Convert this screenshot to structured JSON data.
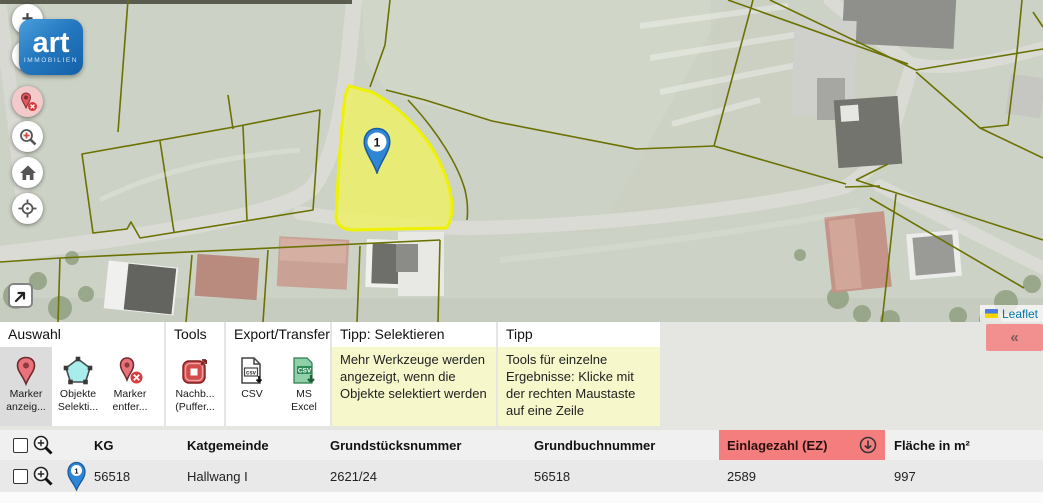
{
  "map": {
    "logo": {
      "line1": "art",
      "line2": "IMMOBILIEN"
    },
    "controls": {
      "zoom_in": "+",
      "zoom_out": "−",
      "icons": [
        "remove-markers-icon",
        "zoom-search-icon",
        "home-icon",
        "locate-icon",
        "expand-arrow-icon"
      ]
    },
    "marker_label": "1",
    "attribution": {
      "label": "Leaflet",
      "flag_icon": "ukraine-flag-icon"
    }
  },
  "toolbar": {
    "sections": [
      {
        "title": "Auswahl",
        "buttons": [
          {
            "label1": "Marker",
            "label2": "anzeig...",
            "icon": "marker-icon",
            "selected": true
          },
          {
            "label1": "Objekte",
            "label2": "Selekti...",
            "icon": "polygon-select-icon",
            "selected": false
          },
          {
            "label1": "Marker",
            "label2": "entfer...",
            "icon": "marker-remove-icon",
            "selected": false
          }
        ]
      },
      {
        "title": "Tools",
        "buttons": [
          {
            "label1": "Nachb...",
            "label2": "(Puffer...",
            "icon": "buffer-tool-icon",
            "selected": false
          }
        ]
      },
      {
        "title": "Export/Transfer",
        "buttons": [
          {
            "label1": "CSV",
            "label2": "",
            "icon": "csv-download-icon",
            "selected": false
          },
          {
            "label1": "MS",
            "label2": "Excel",
            "icon": "excel-download-icon",
            "selected": false
          }
        ]
      },
      {
        "title": "Tipp: Selektieren",
        "tip": "Mehr Werkzeuge werden angezeigt, wenn die Objekte selektiert werden"
      },
      {
        "title": "Tipp",
        "tip": "Tools für einzelne Ergebnisse: Klicke mit der rechten Maustaste auf eine Zeile"
      }
    ],
    "collapse_label": "«"
  },
  "table": {
    "columns": {
      "kg": "KG",
      "katgemeinde": "Katgemeinde",
      "grundstuecksnummer": "Grundstücksnummer",
      "grundbuchnummer": "Grundbuchnummer",
      "einlagezahl": "Einlagezahl (EZ)",
      "flaeche": "Fläche in m²"
    },
    "sort": {
      "column": "Einlagezahl (EZ)",
      "direction": "down",
      "icon": "sort-down-circle-icon"
    },
    "rows": [
      {
        "marker": "1",
        "kg": "56518",
        "katgemeinde": "Hallwang I",
        "grundstuecksnummer": "2621/24",
        "grundbuchnummer": "56518",
        "einlagezahl": "2589",
        "flaeche": "997"
      }
    ]
  },
  "colors": {
    "selected_parcel": "#eef200",
    "parcel_line": "#6b7202",
    "marker_blue": "#2e86d5",
    "highlight_pink": "#f47e7e",
    "tip_yellow": "#f6f7cb",
    "logo_blue": "#1360a8",
    "attribution_link": "#0078A8"
  }
}
